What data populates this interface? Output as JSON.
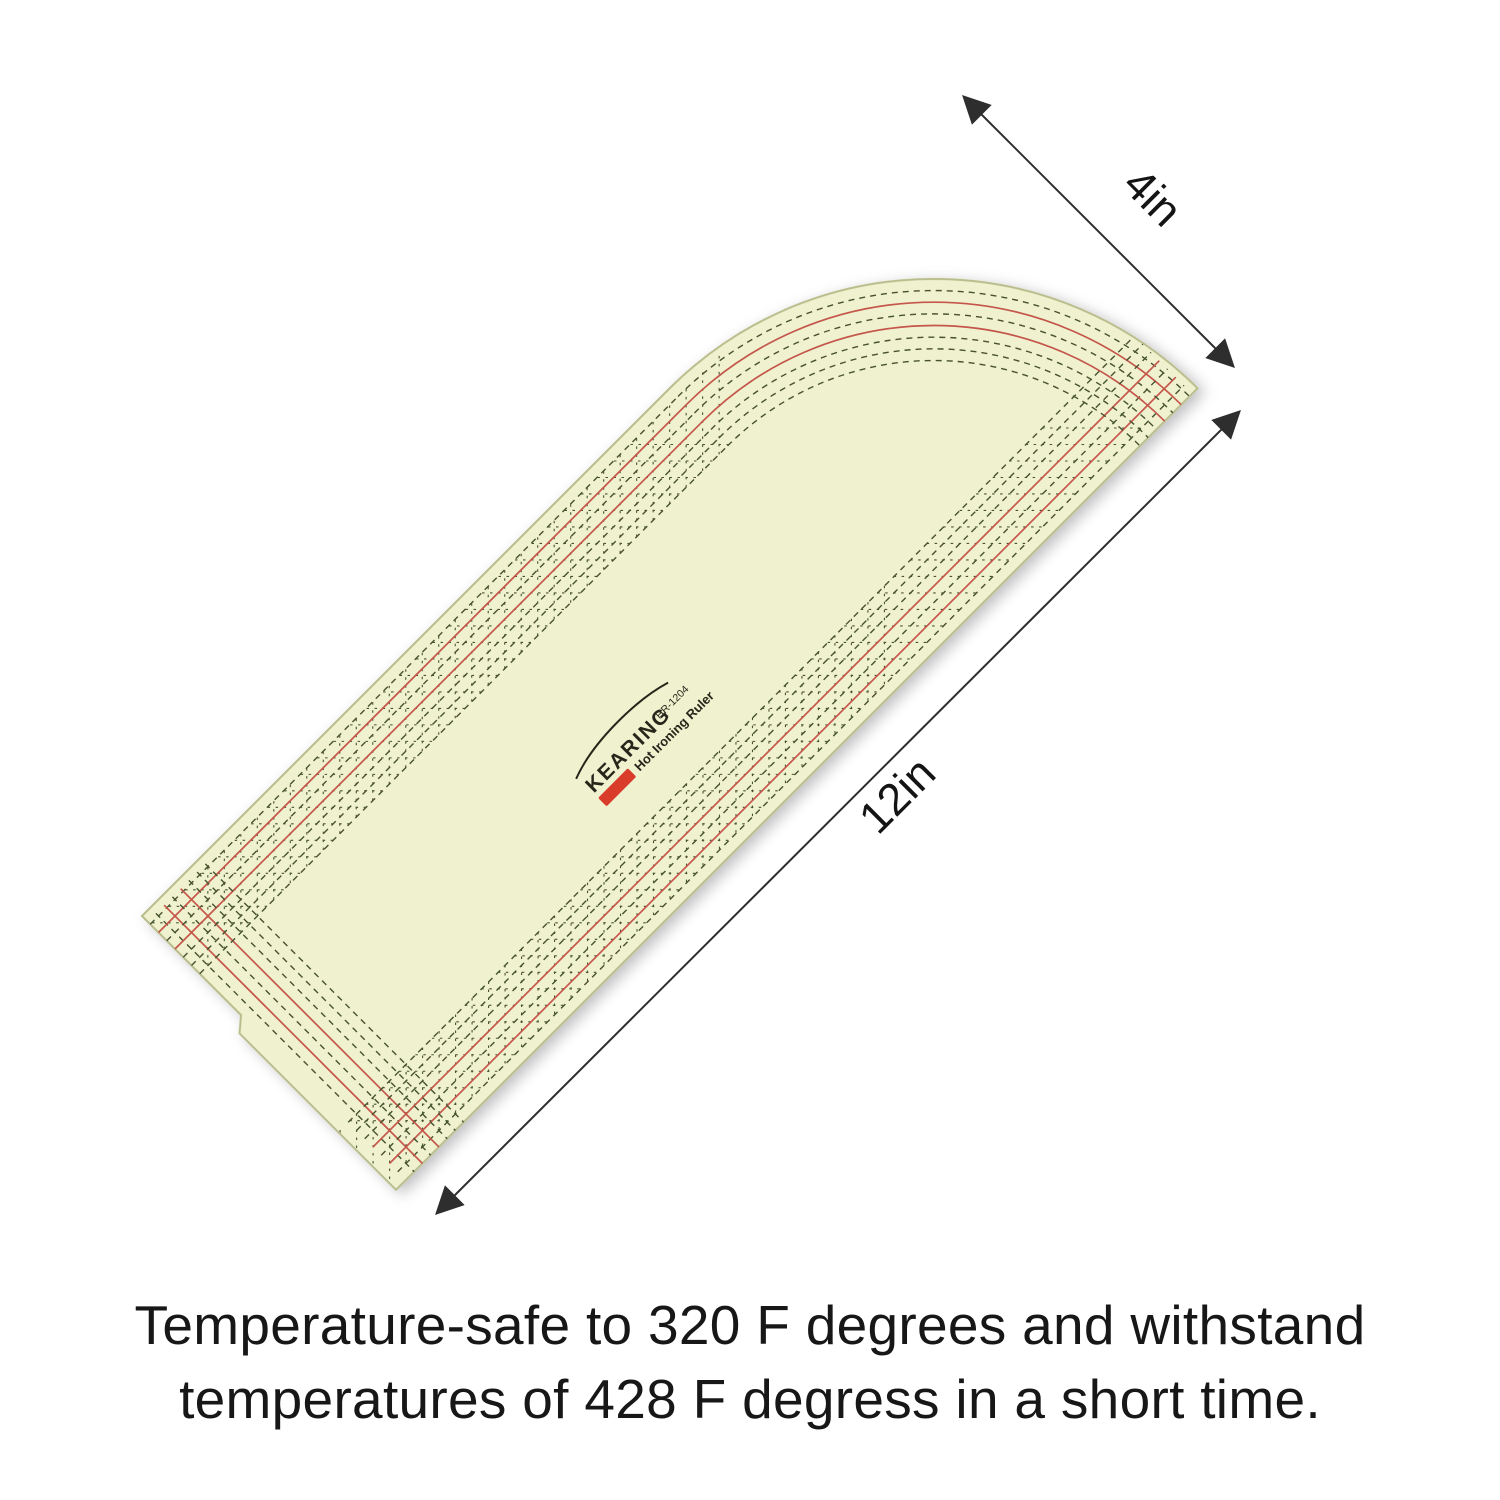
{
  "caption": {
    "line1": "Temperature-safe to 320 F degrees and withstand",
    "line2": "temperatures of 428 F degress in a short time."
  },
  "dimensions": {
    "width_label": "4in",
    "length_label": "12in"
  },
  "ruler": {
    "brand": "KEARING",
    "model": "HR-1204",
    "product_name": "Hot Ironing Ruler",
    "inch_label": "INCH",
    "radius_label": "4R",
    "edge_numbers": [
      "1",
      "2",
      "3",
      "4",
      "5",
      "6",
      "7",
      "9",
      "10",
      "11"
    ],
    "cross_scale_numbers": [
      "1",
      "2",
      "3"
    ],
    "angle_labels": [
      "60°",
      "45°",
      "30°"
    ],
    "bottom_fractions": [
      {
        "t": "1/4",
        "red": true
      },
      {
        "t": "3/8",
        "red": false
      },
      {
        "t": "1/2",
        "red": true
      },
      {
        "t": "5/8",
        "red": false
      },
      {
        "t": "3/4",
        "red": false
      },
      {
        "t": "7/8",
        "red": false
      }
    ],
    "top_fractions": [
      {
        "t": "1/4",
        "red": true
      },
      {
        "t": "3/8",
        "red": false
      },
      {
        "t": "1/2",
        "red": true
      },
      {
        "t": "5/8",
        "red": false
      }
    ],
    "left_fractions": [
      {
        "t": "1/4",
        "red": true
      },
      {
        "t": "3/8",
        "red": false
      },
      {
        "t": "1/2",
        "red": true
      },
      {
        "t": "5/8",
        "red": false
      },
      {
        "t": "3/4",
        "red": false
      },
      {
        "t": "7/8",
        "red": false
      }
    ],
    "colors": {
      "body": "#eff1cf",
      "line": "#26261b",
      "red": "#c4564a",
      "dash": "#47522f",
      "cross": "#d0756a",
      "chip": "#d93c2b"
    }
  }
}
